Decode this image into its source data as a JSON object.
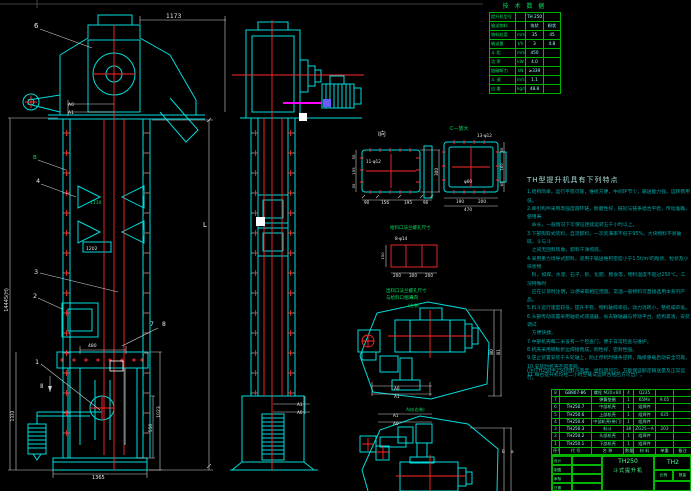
{
  "colors": {
    "background": "#000000",
    "line_cyan": "#00dcdc",
    "centerline_red": "#ff2a2a",
    "table_green": "#00b400",
    "text_green": "#00e060",
    "notes_teal": "#00a9a9",
    "magenta": "#ff00ff",
    "violet": "#6a5aff"
  },
  "tech_table": {
    "title": "技 术 数 据",
    "rows": [
      [
        "提升机型号",
        "",
        "TH 250",
        ""
      ],
      [
        "输送物料",
        "",
        "块状",
        "粉状"
      ],
      [
        "物料粒度",
        "mm",
        "35",
        "45"
      ],
      [
        "输送量",
        "t/h",
        "3",
        "4.8"
      ],
      [
        "斗 距",
        "mm",
        "450",
        ""
      ],
      [
        "功 率",
        "kW",
        "4.0",
        ""
      ],
      [
        "链破断力",
        "kN",
        "≥339",
        ""
      ],
      [
        "斗 速",
        "m/s",
        "1.1",
        ""
      ],
      [
        "自 重",
        "kg/m",
        "48.8",
        ""
      ]
    ]
  },
  "notes": {
    "title": "TH型提升机具有下列特点",
    "lines": [
      "1.结构简单，运行平稳可靠，维修方便，中间环节少，输送能力强，运转费用低。",
      "2.牵引构件采用高强度圆环链，耐磨性好，链轮与链条啮合平稳，传动准确，使用寿",
      "　命长，一般情况下可保证连续运转五千小时以上。",
      "3.下部掏取式装料，自流卸料，一次装满率不低于95%，大块物料不易破碎，斗与斗",
      "　之间无回料现象，卸料干净彻底。",
      "4.采用重力诱导式卸料，适用于输送堆积密度小于1.5t/m³的粉状、粒状及小块状物",
      "　料，如煤、水泥、石子、砂、化肥、粮食等，物料温度不超过250℃。工况特殊时",
      "　应在订货时注明，以便采取相应措施，常温一般物料可直接选用本系列产品。",
      "5.料斗运行速度较低，提升平稳，物料破碎率低，动力消耗小，整机噪声低。",
      "6.头部传动装置采用轴装式减速器，省去联轴器与传动平台，结构紧凑，安装调试",
      "　方便快捷。",
      "7.中部机壳每二米设有一个检查门，便于日常检查与维护。",
      "8.机壳采用钢板折边焊接而成，刚性好，密封性强。",
      "9.逆止装置安装于头轮轴上，防止停机时链条逆转，确保重载启动安全可靠。",
      "10.安装时机壳不得歪斜。",
      "11.每台提升机均经二小时空载试运转合格后方可出厂。"
    ],
    "footnote": "(注)TH250中250为料斗宽度，给料须均匀，方能保证额定输送量及正常运行。"
  },
  "bom": {
    "header": [
      "序号",
      "代 号",
      "名 称",
      "数量",
      "材 料",
      "单重",
      "备注"
    ],
    "rows": [
      [
        "8",
        "GB907-86",
        "螺栓 M20×80",
        "4",
        "Q235",
        "",
        ""
      ],
      [
        "7",
        "",
        "弹簧垫圈",
        "1",
        "65Mn",
        "9.05",
        ""
      ],
      [
        "6",
        "TH250.7",
        "中部机壳",
        "1",
        "组焊件",
        "",
        ""
      ],
      [
        "5",
        "TH250.6",
        "上部机壳",
        "1",
        "组焊件",
        "635",
        ""
      ],
      [
        "4",
        "TH250.4",
        "中部机壳(带门)",
        "1",
        "组焊件",
        "",
        ""
      ],
      [
        "3",
        "TH250.3",
        "料斗",
        "38",
        "ZG25—A",
        "203",
        ""
      ],
      [
        "2",
        "TH250.2",
        "头部机壳",
        "1",
        "组焊件",
        "",
        ""
      ],
      [
        "1",
        "TH250.1",
        "下部机壳",
        "1",
        "组焊件",
        "",
        ""
      ]
    ]
  },
  "title_block": {
    "model": "TH250",
    "product": "斗式提升机",
    "model_right": "TH2",
    "left_rows": [
      "设计",
      "制图",
      "审核",
      "日期"
    ],
    "scale_label": "比例",
    "qty_label": "数量"
  },
  "dims": {
    "d1173": "1173",
    "a0": "A0",
    "a1": "A1",
    "g1130": "1130",
    "d1202": "1202",
    "d480": "480",
    "d1365": "1365",
    "d1023": "1023",
    "d550": "550",
    "dH": "14445(H)",
    "d1333": "1333",
    "L": "L",
    "sec2": "Ⅱ",
    "m_a1": "A1",
    "m_a0": "A0",
    "tv1_a0": "A0",
    "tv1_a1": "A1",
    "tv1_b0": "B0",
    "tv1_b1": "B1",
    "tv2_a1": "A1",
    "tv2_a0": "A0",
    "tv2_b": "B",
    "tv2_a": "a"
  },
  "balloons": {
    "n1": "1",
    "n2": "2",
    "n3": "3",
    "n4": "4",
    "n6": "6",
    "n7": "7",
    "n8": "8",
    "B": "B"
  },
  "details": {
    "i_title": "Ⅰ向",
    "i_holes": "11-φ12",
    "i_right": "300",
    "i_b0": "90",
    "i_b1": "156",
    "i_b2": "195",
    "i_b3": "90",
    "i_l0": "55",
    "i_l1": "155",
    "i_l2": "55",
    "c_title": "C—放大",
    "c_holes": "13-φ12",
    "c_center": "φ60",
    "c_b0": "190",
    "c_b1": "200",
    "c_total": "470",
    "c_r0": "65",
    "c_r1": "160",
    "c_r2": "65",
    "feed_title": "给料口法兰螺孔尺寸",
    "feed_holes": "8-φ14",
    "feed_left": "150",
    "feed_b0": "200",
    "feed_b1": "300",
    "feed_b2": "200",
    "note1": "出料口法兰螺孔尺寸",
    "note2": "与给料口相同",
    "a1_label": "A向",
    "a1_sub": "(左装)",
    "a2_label": "A向(右装)"
  }
}
